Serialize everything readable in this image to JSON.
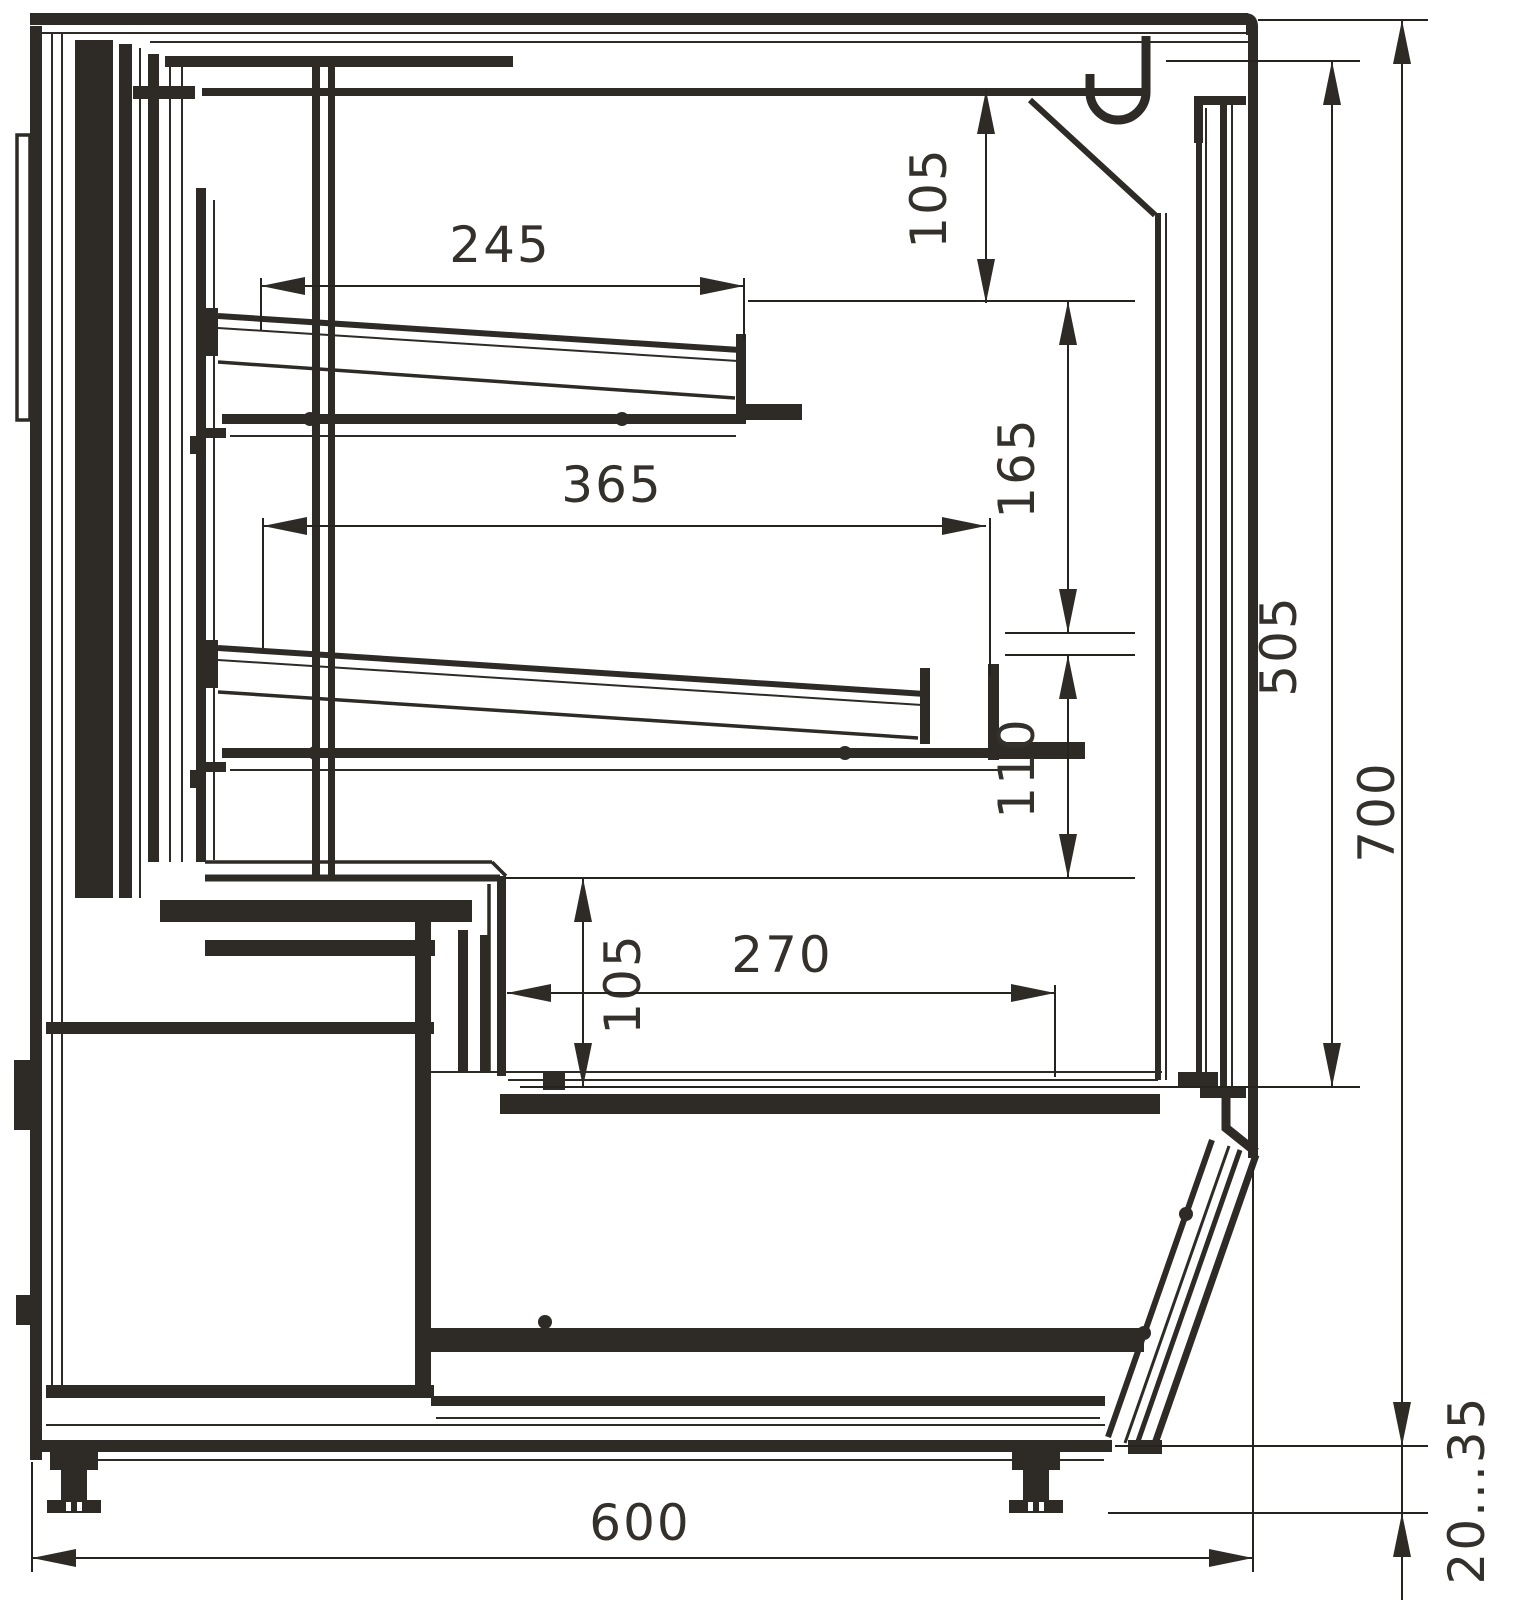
{
  "drawing": {
    "kind": "display-case-side-cross-section",
    "colors": {
      "ink": "#2e2b27",
      "background": "#ffffff"
    },
    "dimensions": {
      "top_shelf_length": "245",
      "middle_shelf_length": "365",
      "canopy_to_top_shelf": "105",
      "top_to_middle_shelf": "165",
      "middle_shelf_to_counter": "110",
      "counter_to_well": "105",
      "well_opening_width": "270",
      "display_opening_height": "505",
      "overall_height": "700",
      "overall_depth": "600",
      "foot_adjustment_range": "20...35"
    }
  }
}
